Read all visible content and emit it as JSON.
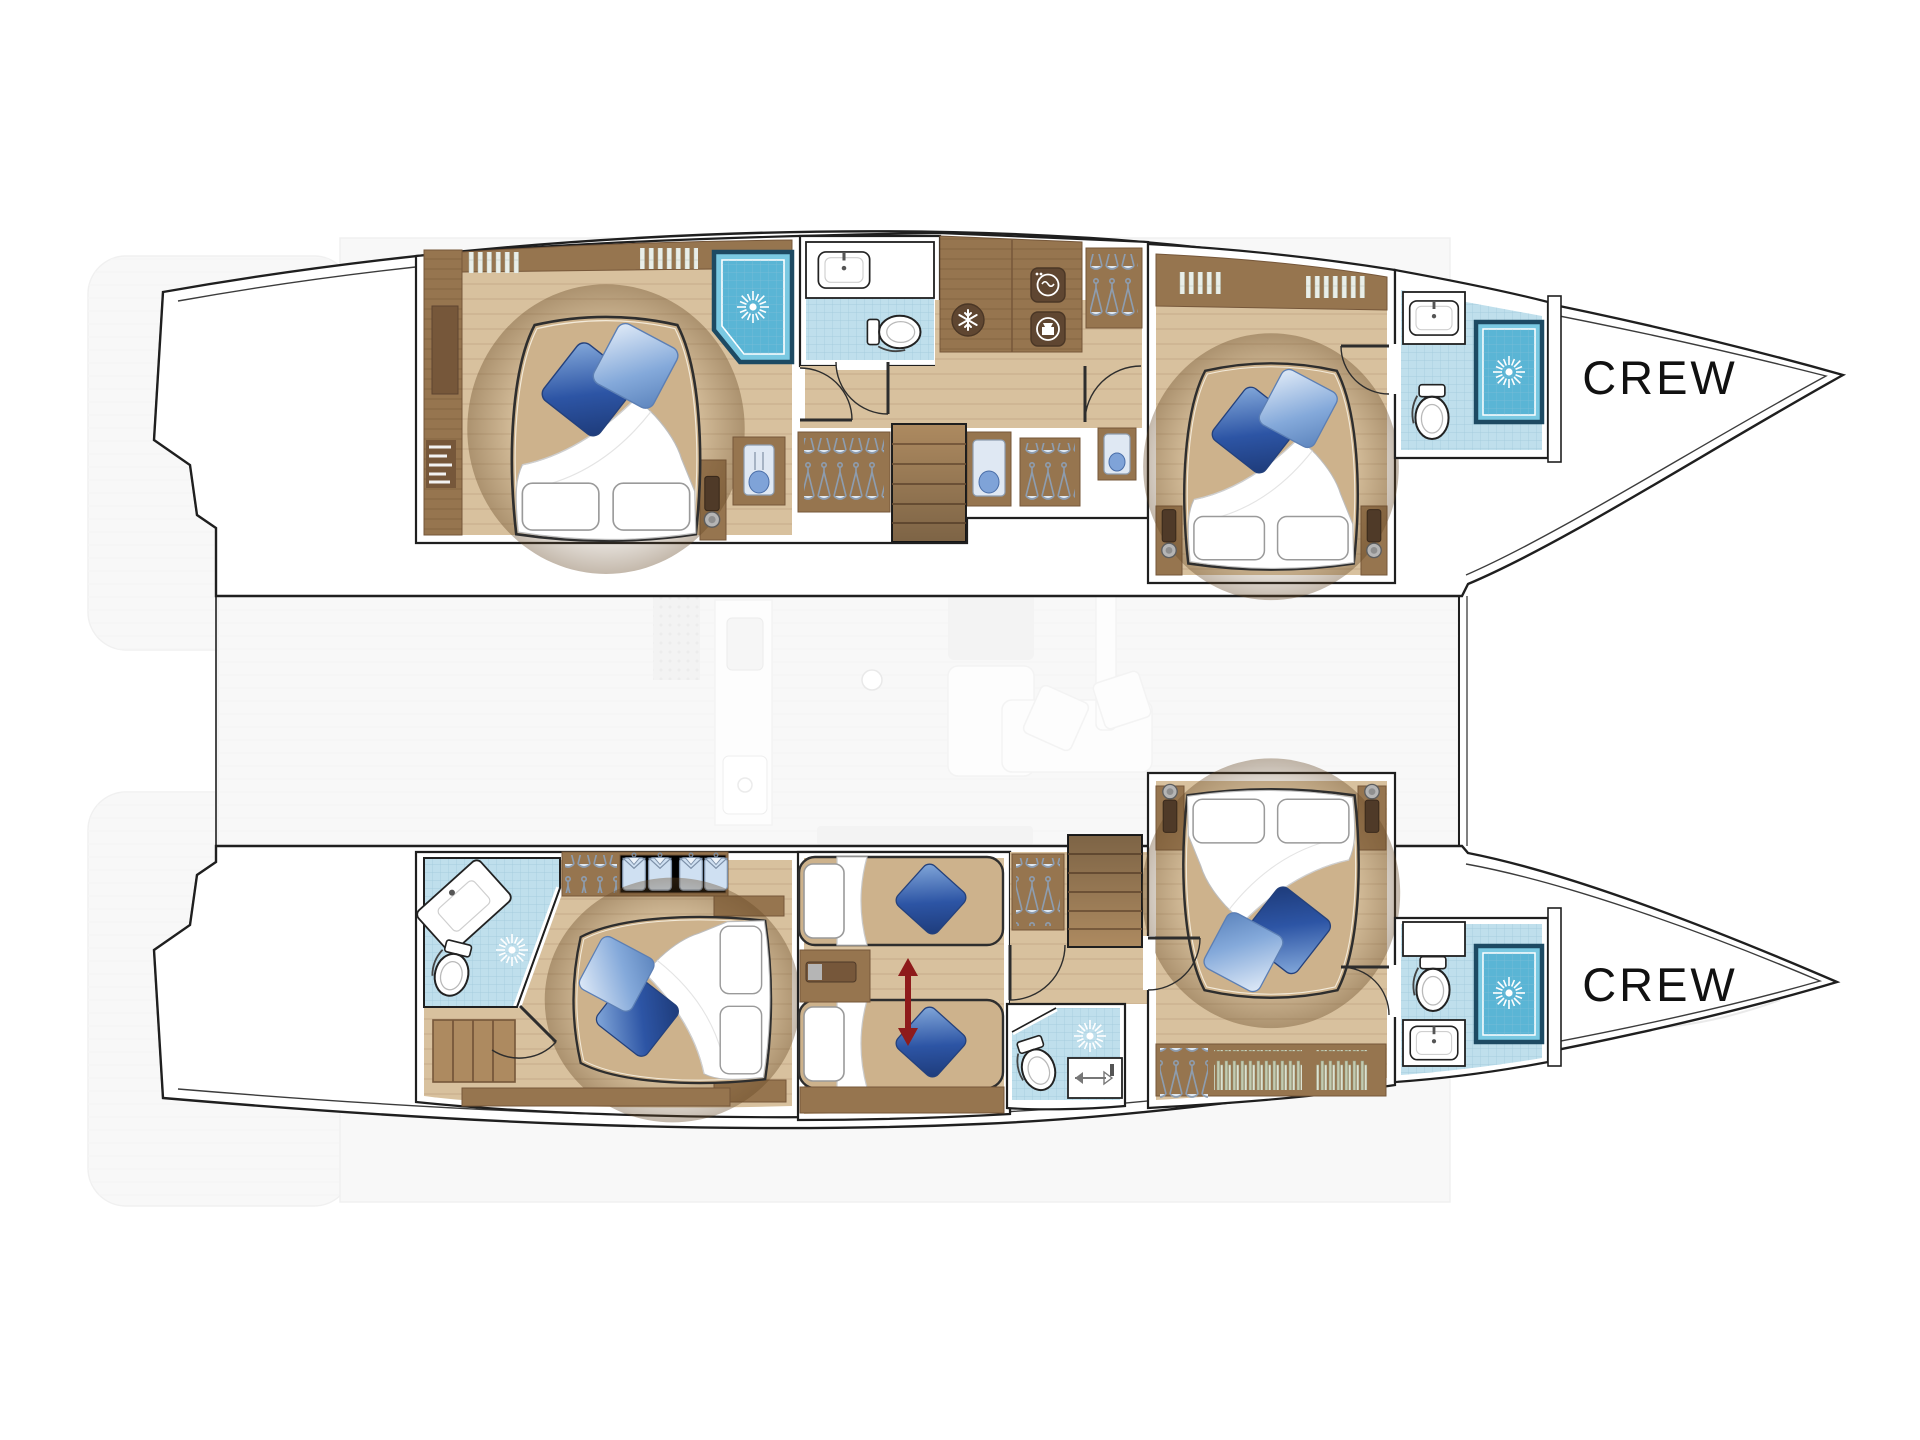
{
  "page": {
    "background": "#ffffff",
    "description": "Top-down lower-deck accommodation plan of a sailing catamaran with two hulls, five guest cabins, five bathrooms and two forward crew areas"
  },
  "labels": {
    "crew_bow_top": "CREW",
    "crew_bow_bottom": "CREW"
  },
  "typography": {
    "crew_font_size_px": 47,
    "crew_letter_spacing_px": 3
  },
  "colors": {
    "page": "#ffffff",
    "line": "#1f1f1f",
    "crewColor": "#111111",
    "floor": "#d8c19e",
    "floorEdge": "#c2a77e",
    "wood": "#96754f",
    "woodDark": "#76573a",
    "woodLight": "#ad8a60",
    "tile": "#bfdfec",
    "tileGrid": "#9fc9da",
    "shower": "#7ac9e2",
    "showerDeep": "#5ab5d5",
    "showerFrame": "#1d4a63",
    "mattress": "#cdb28c",
    "pillowDark1": "#2d55a5",
    "pillowDark2": "#86abdc",
    "pillowLight1": "#84a9da",
    "pillowLight2": "#e2ecf8",
    "accentRed": "#8e1b1b",
    "iconBg": "#5f4631",
    "fadedFill": "#f5f5f5",
    "fadedLine": "#e7e7e7",
    "fadedDark": "#ececec",
    "hanger": "#8d9db0",
    "shirtFill": "#cfe0f2",
    "lampWood": "#4f3a28"
  },
  "plan": {
    "vessel_type": "sailing catamaran",
    "view": "lower deck layout, bows pointing right",
    "hulls": [
      {
        "id": "upper-hull",
        "rooms": [
          {
            "name": "aft-double-cabin",
            "features": [
              "double-bed",
              "two-white-pillows",
              "two-blue-accent-pillows",
              "wardrobe-cabinets",
              "corner-shower",
              "window-blinds",
              "bedside-lamps",
              "decor-vase-niche"
            ]
          },
          {
            "name": "aft-head",
            "features": [
              "washbasin",
              "toilet",
              "tiled-floor"
            ]
          },
          {
            "name": "galley-utility-corridor",
            "features": [
              "fridge-freezer-icon",
              "washing-machine-icon",
              "tumble-dryer-icon",
              "hanging-lockers",
              "staircase",
              "storage-niches"
            ]
          },
          {
            "name": "midship-double-cabin",
            "features": [
              "double-bed",
              "two-white-pillows",
              "two-blue-accent-pillows",
              "bedside-lamps",
              "window-blinds"
            ]
          },
          {
            "name": "forward-head",
            "features": [
              "washbasin",
              "toilet",
              "shower-cabin",
              "tiled-floor"
            ]
          },
          {
            "name": "crew-bow-area",
            "label": "CREW"
          }
        ]
      },
      {
        "id": "lower-hull",
        "rooms": [
          {
            "name": "aft-double-cabin",
            "features": [
              "double-bed",
              "corner-bathroom",
              "tilted-washbasin",
              "toilet",
              "shower-rose",
              "shirt-shelves",
              "hanging-rail",
              "step-ladder"
            ]
          },
          {
            "name": "twin-convertible-cabin",
            "features": [
              "two-single-beds",
              "convertible-double-arrow",
              "nightstand",
              "hanging-locker"
            ]
          },
          {
            "name": "midship-shower-room",
            "features": [
              "toilet",
              "shower-rose",
              "slide-out-tray",
              "tiled-floor"
            ]
          },
          {
            "name": "staircase",
            "features": [
              "six-treads"
            ]
          },
          {
            "name": "forward-double-cabin",
            "features": [
              "double-bed",
              "two-white-pillows",
              "two-blue-accent-pillows",
              "bookshelf",
              "hanging-locker",
              "bedside-lamps"
            ]
          },
          {
            "name": "forward-head",
            "features": [
              "washbasin",
              "toilet",
              "shower-cabin",
              "tiled-floor"
            ]
          },
          {
            "name": "crew-bow-area",
            "label": "CREW"
          }
        ]
      }
    ],
    "icons": [
      "snowflake-fridge-icon",
      "washing-machine-icon",
      "tumble-dryer-icon",
      "shower-rose-icon",
      "clothes-hanger-icon",
      "shirt-icon",
      "convertible-arrow-icon",
      "bedside-lamp-icon"
    ],
    "counts": {
      "guest_cabins": 5,
      "bathrooms": 5,
      "crew_areas": 2,
      "staircases": 2
    }
  }
}
